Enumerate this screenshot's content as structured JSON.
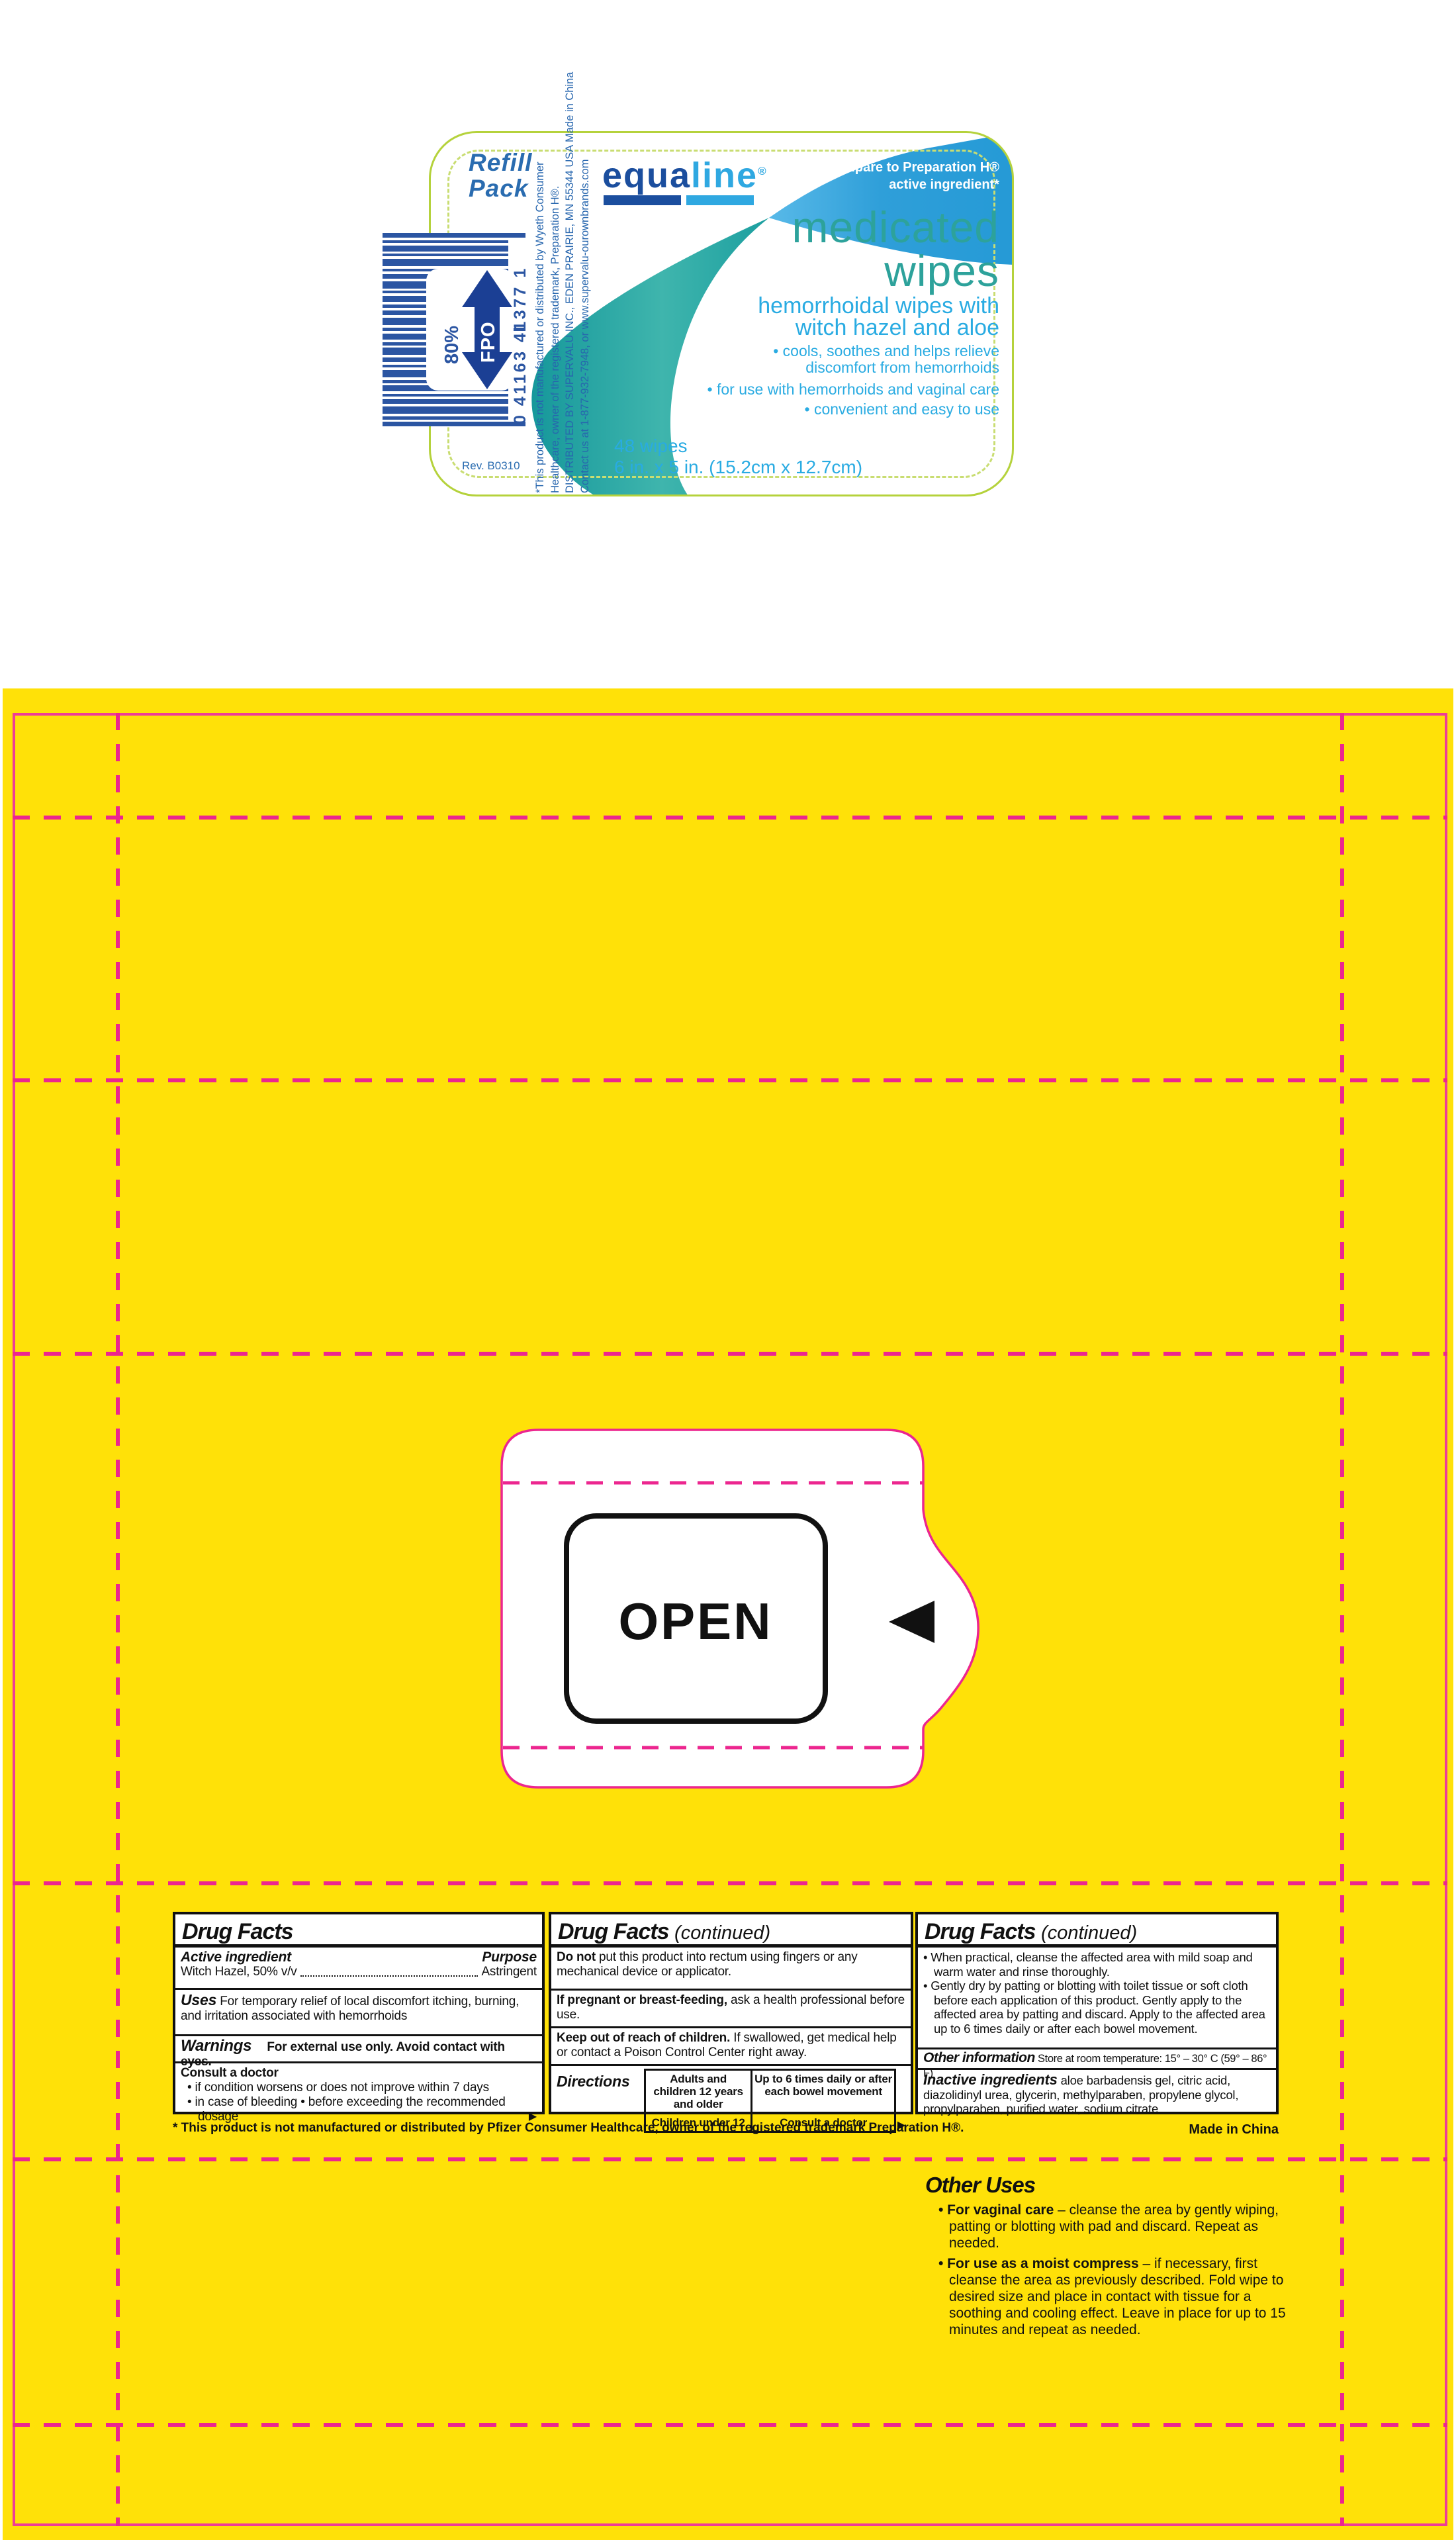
{
  "colors": {
    "yellow": "#ffe108",
    "magenta_dieline": "#ec268f",
    "brand_blue_dark": "#1b4e9e",
    "brand_blue_light": "#2fa8e1",
    "teal_swoosh": "#1fa7a2",
    "title_teal": "#2da29b",
    "label_green_border": "#b5d23c",
    "barcode_blue": "#2b55a2"
  },
  "label": {
    "refill_pack": "Refill Pack",
    "rev": "Rev. B0310",
    "barcode": {
      "digits": "0 41163 41377 1",
      "fpo": "FPO",
      "percent": "80%"
    },
    "vertical_text": {
      "line1": "*This product is not manufactured or distributed by Wyeth Consumer",
      "line2": "Healthcare, owner of the registered trademark, Preparation H®.",
      "line3": "DISTRIBUTED BY SUPERVALU INC., EDEN PRAIRIE, MN 55344 USA   Made in China",
      "line4": "Contact us at 1-877-932-7948, or www.supervalu-ourownbrands.com"
    },
    "brand": {
      "part1": "equa",
      "part2": "line",
      "reg": "®"
    },
    "compare": {
      "line1": "compare to Preparation H®",
      "line2": "active ingredient*"
    },
    "title": {
      "line1": "medicated",
      "line2": "wipes"
    },
    "subtitle": {
      "line1": "hemorrhoidal wipes with",
      "line2": "witch hazel and aloe"
    },
    "bullets": {
      "b1a": "• cools, soothes and helps relieve",
      "b1b": "discomfort from hemorrhoids",
      "b2": "• for use with hemorrhoids and vaginal care",
      "b3": "• convenient and easy to use"
    },
    "count": "48 wipes",
    "size": "6 in. x 5 in. (15.2cm x 12.7cm)"
  },
  "flap": {
    "open_label": "OPEN"
  },
  "drug_facts": {
    "panel1": {
      "title": "Drug Facts",
      "active_head": "Active ingredient",
      "purpose_head": "Purpose",
      "active_name": "Witch Hazel, 50% v/v",
      "purpose_value": "Astringent",
      "uses_head": "Uses",
      "uses_text": " For temporary relief of local discomfort itching, burning, and irritation associated with hemorrhoids",
      "warnings_head": "Warnings",
      "warnings_text": "For external use only.  Avoid contact with eyes.",
      "consult_head": "Consult a doctor",
      "consult_b1": "• if condition worsens or does not improve within 7 days",
      "consult_b2": "• in case of bleeding • before exceeding the recommended dosage",
      "arrow": "▶"
    },
    "panel2": {
      "title": "Drug Facts",
      "continued": "(continued)",
      "donot_head": "Do not",
      "donot_text": "  put this product into rectum using fingers or any mechanical device or applicator.",
      "pregnant_head": "If pregnant or breast-feeding,",
      "pregnant_text": " ask a health professional before use.",
      "keep_head": "Keep out of reach of children.",
      "keep_text": " If swallowed, get medical help or contact a Poison Control Center right away.",
      "directions_head": "Directions",
      "directions_rows": [
        [
          "Adults and children 12 years and older",
          "Up to 6 times daily or after each bowel movement"
        ],
        [
          "Children under 12",
          "Consult a doctor"
        ]
      ],
      "arrow": "▶"
    },
    "panel3": {
      "title": "Drug Facts",
      "continued": "(continued)",
      "bullet1": "• When practical, cleanse the affected area with mild soap and warm water and rinse thoroughly.",
      "bullet2": "• Gently dry by patting or blotting with toilet tissue or soft cloth before each application of this product. Gently apply to the affected area by patting and discard. Apply to the affected  area up to 6 times daily or after each bowel movement.",
      "other_head": "Other information",
      "other_text": "  Store at room temperature: 15° – 30° C (59° – 86° F)",
      "inactive_head": "Inactive ingredients",
      "inactive_text": "   aloe barbadensis gel, citric acid, diazolidinyl urea, glycerin, methylparaben, propylene glycol, propylparaben, purified water, sodium citrate"
    },
    "footnote": "* This product is not manufactured or distributed by Pfizer Consumer Healthcare,  owner of the registered trademark Preparation H®.",
    "made_in": "Made in China"
  },
  "other_uses": {
    "title": "Other Uses",
    "b1_head": "• For vaginal care",
    "b1_text": " – cleanse the area by gently wiping, patting  or blotting with pad and discard. Repeat as needed.",
    "b2_head": "• For use as a moist compress",
    "b2_text": " – if necessary, first cleanse the area as previously described. Fold wipe to desired size and place in contact with tissue for a soothing and cooling effect. Leave in place for up to 15 minutes and repeat as needed."
  }
}
